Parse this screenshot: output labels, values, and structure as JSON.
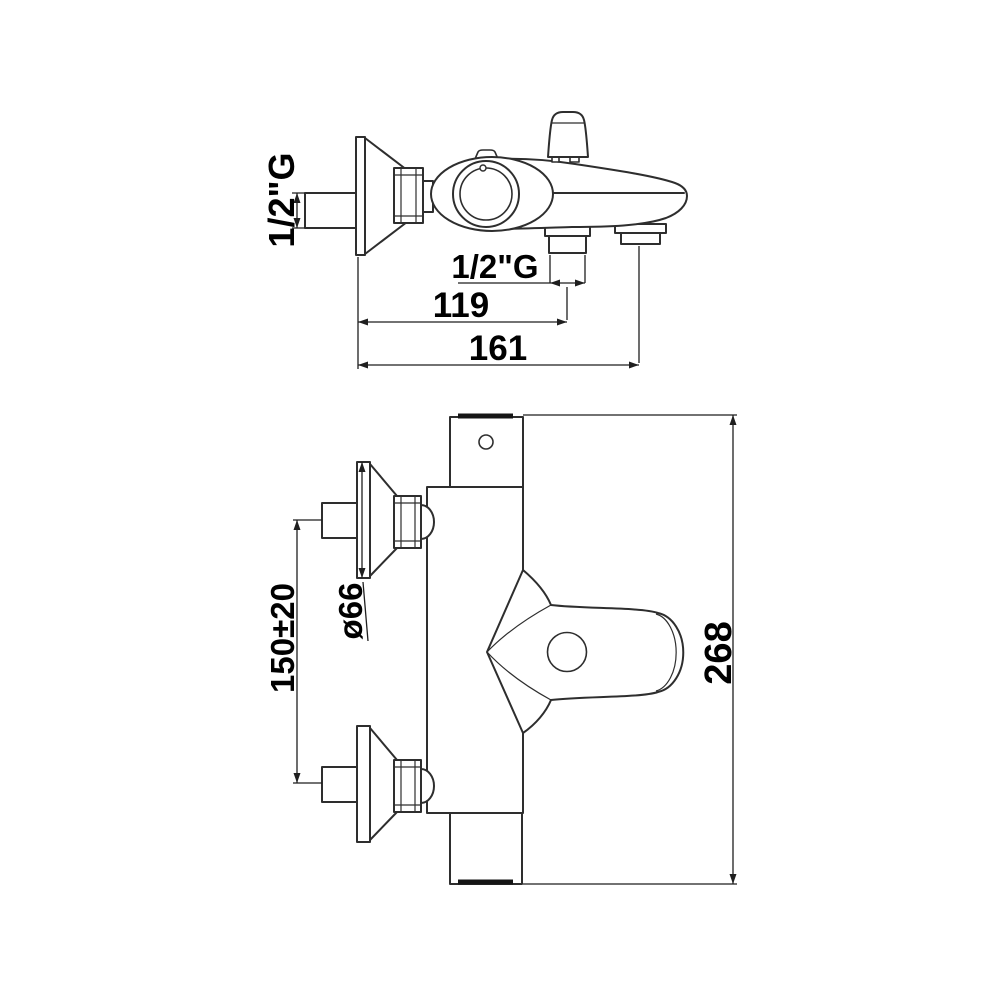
{
  "colors": {
    "line": "#2e2e2e",
    "text": "#000000",
    "background": "#ffffff",
    "knob_band": "#151515"
  },
  "side_view": {
    "wall_inlet_thread": "1/2\"G",
    "handshower_outlet_thread": "1/2\"G",
    "dim_wall_to_outlet": "119",
    "dim_wall_to_spout_end": "161"
  },
  "front_view": {
    "dim_escutcheon_diameter": "ø66",
    "dim_inlet_center_distance": "150±20",
    "dim_overall_length": "268"
  }
}
